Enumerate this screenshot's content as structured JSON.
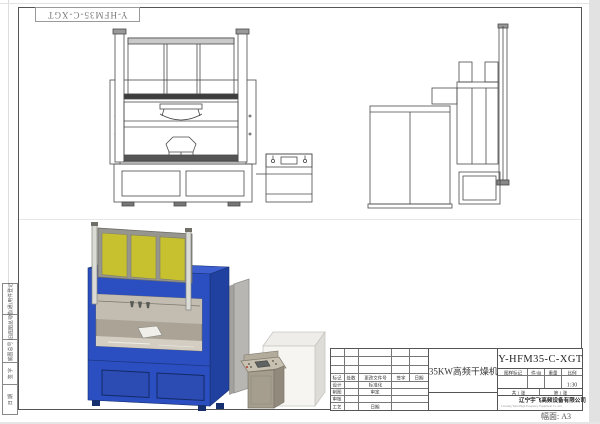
{
  "frame": {
    "corner_part_no": "Y-HFM35-C-XGT",
    "sheet_size_note": "幅面: A3",
    "margin_fields": [
      "借(通)用件登记",
      "旧底图总号",
      "底图总号",
      "签  字",
      "日  期"
    ]
  },
  "title_block": {
    "part_no": "Y-HFM35-C-XGT",
    "part_name": "35KW高频干燥机",
    "revision_header": [
      "标记",
      "处数",
      "更改文件号",
      "签字",
      "日期"
    ],
    "sig_rows": [
      {
        "label": "设计",
        "approver": "标准化"
      },
      {
        "label": "制图",
        "approver": "审定"
      },
      {
        "label": "审核",
        "approver": ""
      },
      {
        "label": "工艺",
        "approver": "日期"
      }
    ],
    "spec_header": [
      "图样标记",
      "件/台",
      "重量",
      "比例"
    ],
    "scale": "1:30",
    "sheets_total": "共 1 张",
    "sheet_number": "第 1 张",
    "company": "辽宁宇飞高频设备有限公司",
    "company_en": "Liaoning Yufei High Frequency Equipment Co.,Ltd"
  },
  "colors": {
    "machine_blue": "#2b4fc0",
    "panel_yellow": "#c7c130",
    "logo_red": "#c5261f",
    "line_gray": "#4a4a4a"
  }
}
